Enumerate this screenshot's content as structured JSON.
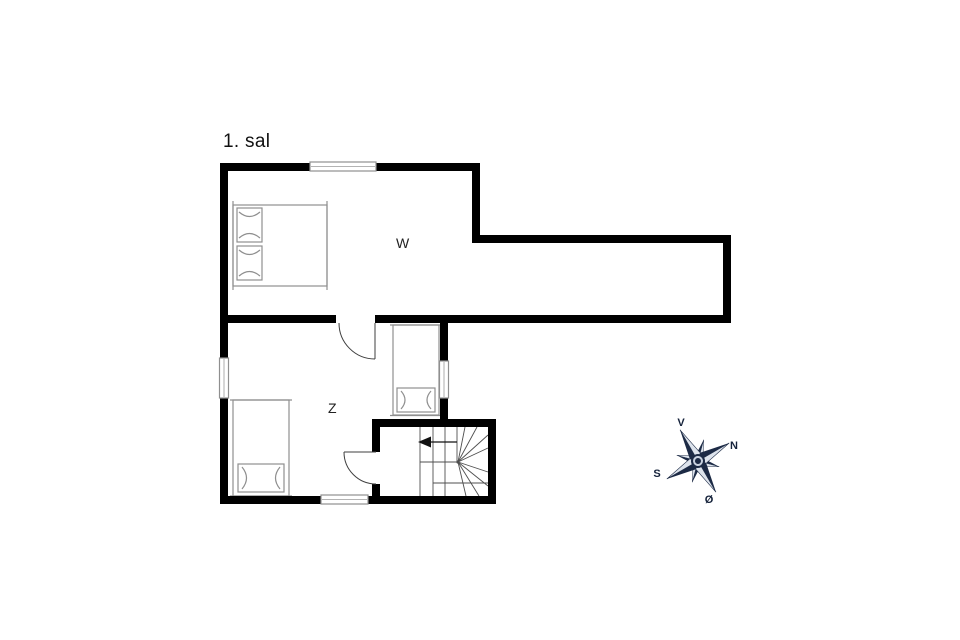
{
  "title": "1. sal",
  "rooms": [
    {
      "id": "W",
      "label": "W"
    },
    {
      "id": "Z",
      "label": "Z"
    }
  ],
  "furniture": [
    {
      "name": "double-bed",
      "room": "W"
    },
    {
      "name": "single-bed",
      "room": "Z"
    },
    {
      "name": "single-bed",
      "room": "Z"
    },
    {
      "name": "winder-staircase",
      "room": "stairwell"
    }
  ],
  "compass": {
    "west": "V",
    "north": "N",
    "south": "S",
    "east": "Ø",
    "rotation_deg": 60,
    "dark_color": "#1c2a45",
    "light_color": "#dde3ec"
  },
  "colors": {
    "background": "#ffffff",
    "wall": "#000000",
    "furniture_line": "#8f8f8f",
    "stair_line": "#4f4f4f",
    "door_line": "#3f3f3f",
    "window_line": "#8f8f8f",
    "text": "#111111"
  }
}
